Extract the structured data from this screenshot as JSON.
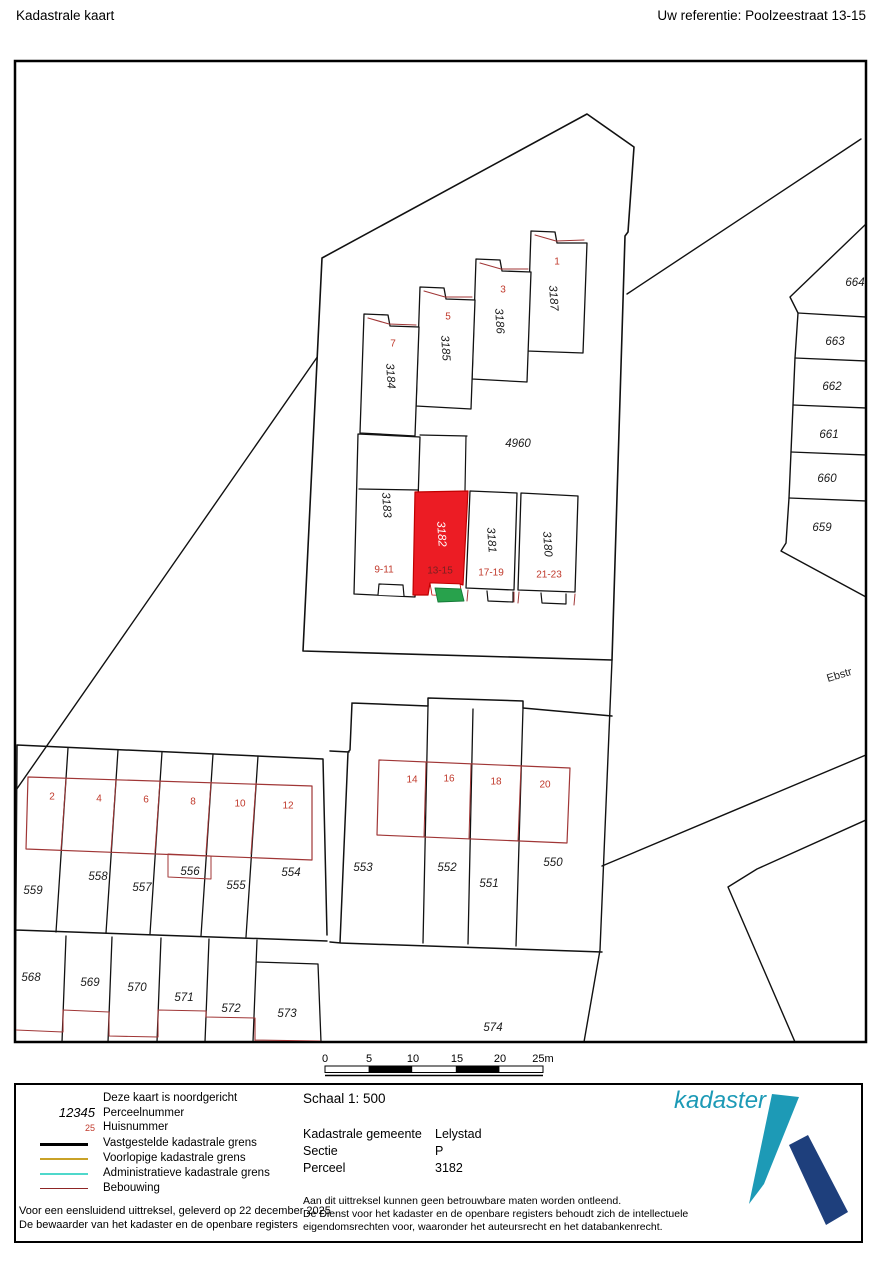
{
  "header": {
    "title": "Kadastrale kaart",
    "reference": "Uw referentie: Poolzeestraat 13-15"
  },
  "map": {
    "street": "Ebstr",
    "area_parcel": "4960",
    "stair_parcels": [
      {
        "parcel": "3187",
        "house": "1"
      },
      {
        "parcel": "3186",
        "house": "3"
      },
      {
        "parcel": "3185",
        "house": "5"
      },
      {
        "parcel": "3184",
        "house": "7"
      }
    ],
    "row_parcels": [
      {
        "parcel": "3183",
        "house": "9-11"
      },
      {
        "parcel": "3182",
        "house": "13-15"
      },
      {
        "parcel": "3181",
        "house": "17-19"
      },
      {
        "parcel": "3180",
        "house": "21-23"
      }
    ],
    "east_parcels": [
      "664",
      "663",
      "662",
      "661",
      "660",
      "659"
    ],
    "west_block": {
      "parcels": [
        "559",
        "558",
        "557",
        "556",
        "555",
        "554"
      ],
      "houses": [
        "2",
        "4",
        "6",
        "8",
        "10",
        "12"
      ]
    },
    "south_block": {
      "parcels": [
        "568",
        "569",
        "570",
        "571",
        "572",
        "573"
      ]
    },
    "mid_block": {
      "parcels": [
        "553",
        "552",
        "551",
        "550"
      ],
      "houses": [
        "14",
        "16",
        "18",
        "20"
      ]
    },
    "south_parcel": "574"
  },
  "scale_bar": {
    "ticks": [
      "0",
      "5",
      "10",
      "15",
      "20",
      "25m"
    ]
  },
  "legend": {
    "items": [
      {
        "symbol": "",
        "label": "Deze kaart is noordgericht"
      },
      {
        "symbol": "12345",
        "label": "Perceelnummer"
      },
      {
        "symbol": "25",
        "label": "Huisnummer"
      },
      {
        "symbol": "line-black",
        "label": "Vastgestelde kadastrale grens"
      },
      {
        "symbol": "line-yellow",
        "label": "Voorlopige kadastrale grens"
      },
      {
        "symbol": "line-cyan",
        "label": "Administratieve kadastrale grens"
      },
      {
        "symbol": "line-darkred",
        "label": "Bebouwing"
      }
    ],
    "certification": [
      "Voor een eensluidend uittreksel, geleverd op 22 december 2025",
      "De bewaarder van het kadaster en de openbare registers"
    ]
  },
  "info": {
    "scale_label": "Schaal 1: 500",
    "rows": [
      {
        "label": "Kadastrale gemeente",
        "value": "Lelystad"
      },
      {
        "label": "Sectie",
        "value": "P"
      },
      {
        "label": "Perceel",
        "value": "3182"
      }
    ],
    "disclaimer": [
      "Aan dit uittreksel kunnen geen betrouwbare maten worden ontleend.",
      "De Dienst voor het kadaster en de openbare registers behoudt zich de intellectuele",
      "eigendomsrechten voor, waaronder het auteursrecht en het databankenrecht."
    ]
  },
  "logo": {
    "text": "kadaster"
  },
  "colors": {
    "selected_parcel": "#ec1c24",
    "building_line": "#a03636",
    "house_number": "#c0392b",
    "house_number_selected": "#7a2121",
    "green_area": "#28a24c",
    "boundary": "#000000",
    "provisional": "#c9a227",
    "administrative": "#4fd8cb",
    "legend_building": "#8e2525",
    "logo_teal": "#1d9ab6",
    "logo_navy": "#1e3f7c"
  }
}
